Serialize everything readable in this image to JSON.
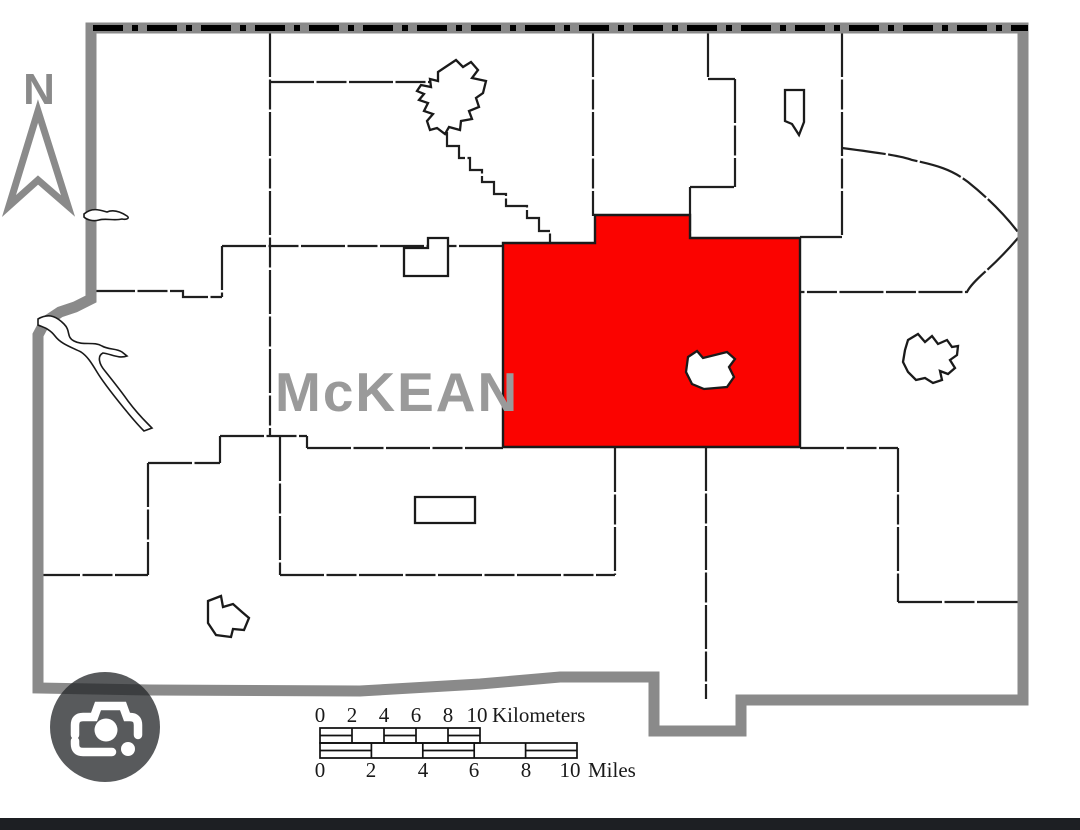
{
  "map": {
    "county_label": "McKEAN",
    "compass_label": "N",
    "highlight_color": "#fb0300",
    "border_color": "#8a8a8a",
    "state_line_color": "#000000"
  },
  "scale_bar": {
    "km_ticks": [
      "0",
      "2",
      "4",
      "6",
      "8",
      "10"
    ],
    "km_unit": "Kilometers",
    "mi_ticks": [
      "0",
      "2",
      "4",
      "6",
      "8",
      "10"
    ],
    "mi_unit": "Miles"
  },
  "lens_button": {
    "icon": "google-lens-camera-icon"
  }
}
